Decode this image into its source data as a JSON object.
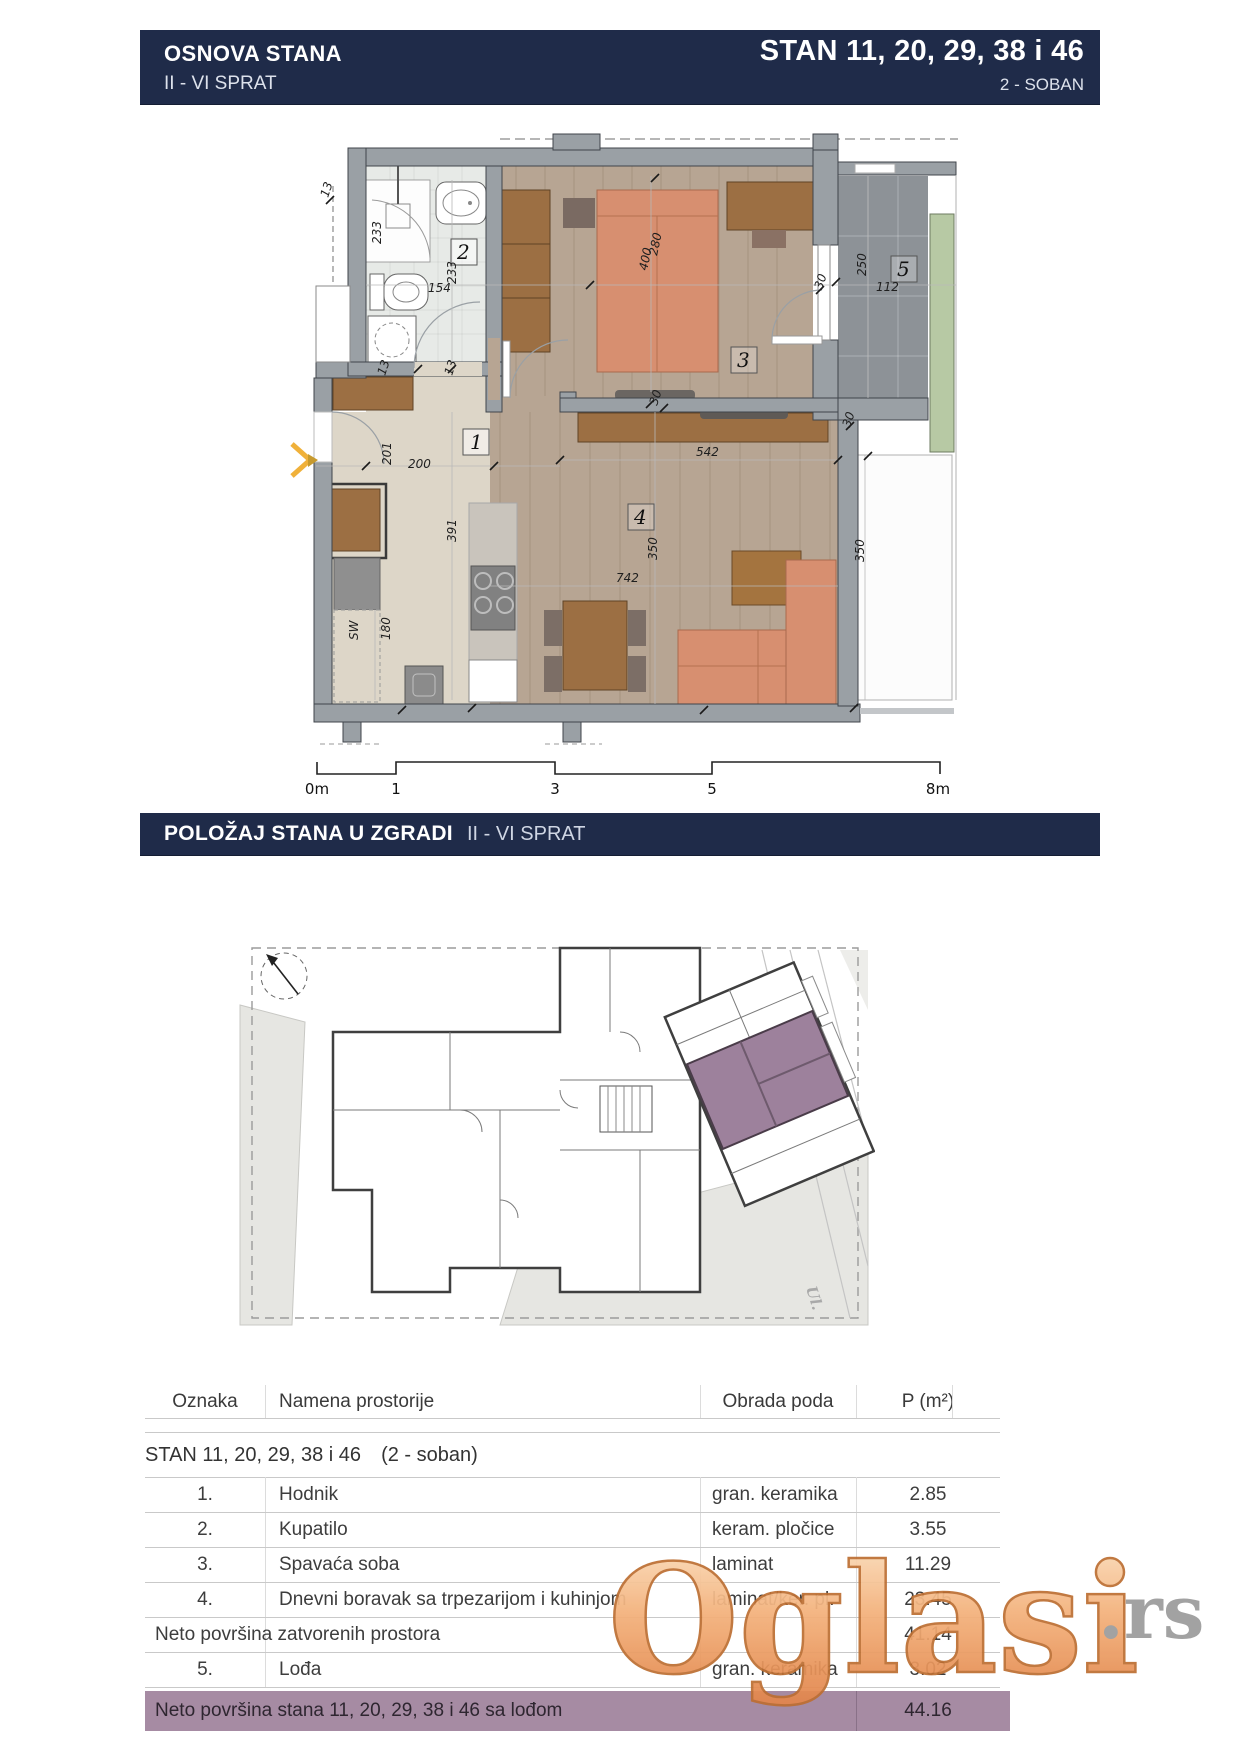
{
  "header": {
    "left_title": "OSNOVA STANA",
    "left_subtitle": "II - VI SPRAT",
    "right_title": "STAN 11, 20, 29, 38 i 46",
    "right_subtitle": "2 - SOBAN"
  },
  "section2": {
    "title": "POLOŽAJ STANA U ZGRADI",
    "subtitle": "II - VI SPRAT"
  },
  "plan": {
    "rooms": {
      "r1": "1",
      "r2": "2",
      "r3": "3",
      "r4": "4",
      "r5": "5"
    },
    "dims": {
      "a233": "233",
      "n154": "154",
      "b233": "233",
      "t13a": "13",
      "t13b": "13",
      "t13c": "13",
      "n201": "201",
      "n200": "200",
      "n391": "391",
      "sw": "SW",
      "n180": "180",
      "n542": "542",
      "n742": "742",
      "a350": "350",
      "b350": "350",
      "n280": "280",
      "n400": "400",
      "t30a": "30",
      "t30b": "30",
      "t30c": "30",
      "n250": "250",
      "n112": "112"
    }
  },
  "scalebar": {
    "l0": "0m",
    "l1": "1",
    "l2": "3",
    "l3": "5",
    "l4": "8m"
  },
  "site": {
    "street_label": "Ul."
  },
  "table": {
    "col_oznaka": "Oznaka",
    "col_namena": "Namena prostorije",
    "col_obrada": "Obrada poda",
    "col_p": "P (m²)",
    "group_title": "STAN 11, 20, 29, 38 i 46",
    "group_suffix": "(2 - soban)",
    "rows": [
      {
        "oznaka": "1.",
        "namena": "Hodnik",
        "obrada": "gran. keramika",
        "p": "2.85"
      },
      {
        "oznaka": "2.",
        "namena": "Kupatilo",
        "obrada": "keram. pločice",
        "p": "3.55"
      },
      {
        "oznaka": "3.",
        "namena": "Spavaća soba",
        "obrada": "laminat",
        "p": "11.29"
      },
      {
        "oznaka": "4.",
        "namena": "Dnevni boravak sa trpezarijom i kuhinjom",
        "obrada": "laminat/ker. pl.",
        "p": "23.45"
      }
    ],
    "subtotal_label": "Neto površina zatvorenih prostora",
    "subtotal_p": "41.14",
    "row5": {
      "oznaka": "5.",
      "namena": "Lođa",
      "obrada": "gran. keramika",
      "p": "3.02"
    },
    "total_label": "Neto površina stana 11, 20, 29, 38 i 46 sa lođom",
    "total_p": "44.16"
  },
  "watermark": {
    "main": "Oglasi",
    "suffix": ".rs"
  },
  "colors": {
    "header_navy": "#1f2b49",
    "total_row_purple": "#a68ba3",
    "unit_highlight_purple": "#9d819c",
    "watermark_orange": "#eb9a5e",
    "watermark_gray": "#9b9b9b",
    "planter_green": "#b7c9a4",
    "bed_sofa_orange": "#d78f70",
    "wall_gray": "#9aa0a5"
  }
}
